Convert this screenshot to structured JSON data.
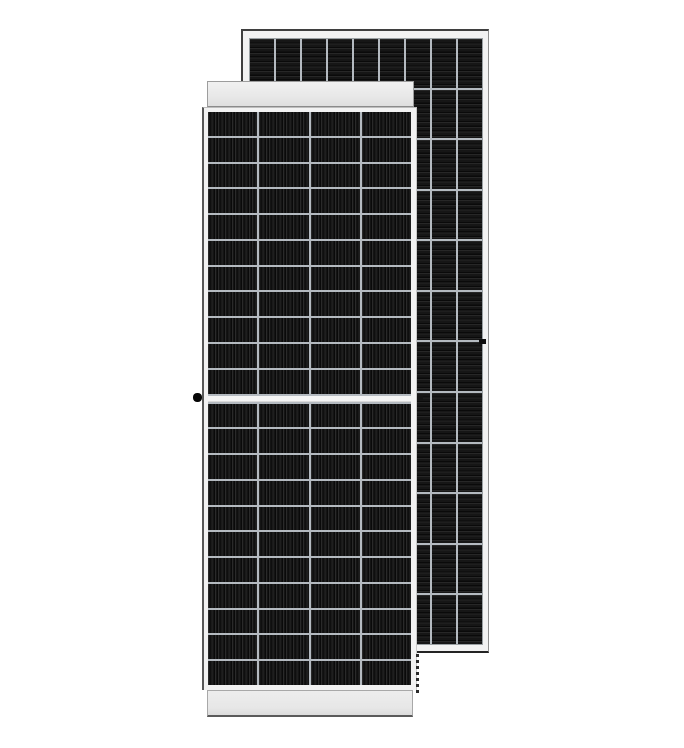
{
  "scene": {
    "alt": "Product photo of two dark monocrystalline solar panels on a white background: front view panel in the foreground with white frame rails top and bottom, rear view panel offset behind it to the upper right"
  },
  "front_panel": {
    "name": "front-view solar panel",
    "columns": 4,
    "rows_top": 11,
    "rows_bottom": 11,
    "has_middle_divider": true,
    "stripe_direction": "vertical"
  },
  "back_panel": {
    "name": "rear-view solar panel",
    "columns": 9,
    "rows": 12,
    "stripe_direction": "horizontal"
  },
  "colors": {
    "background": "#ffffff",
    "cell_dark": "#161616",
    "cell_stripe_light": "#2a2a2a",
    "cell_stripe_shadow": "#0a0a0a",
    "grid_line": "#b4bac0",
    "frame_fill": "#f2f2f2",
    "frame_edge_dark": "#3f3f3f",
    "rail_fill": "#e9e9e9",
    "rail_bottom_edge": "#5a5a5a"
  }
}
